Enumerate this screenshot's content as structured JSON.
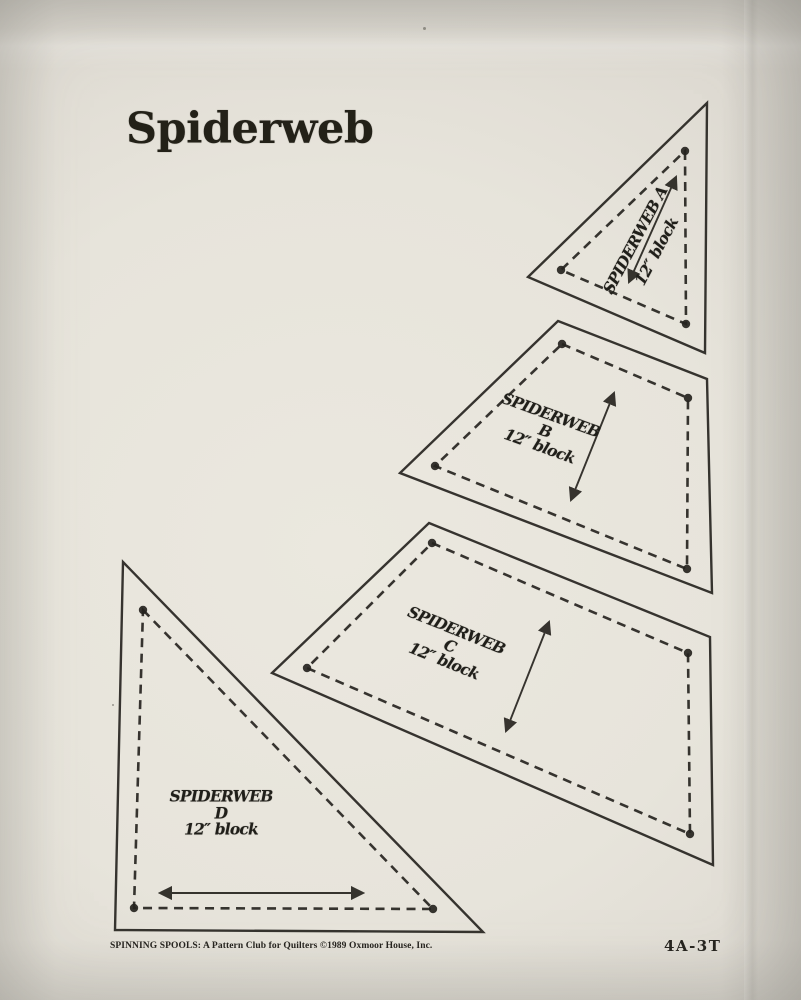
{
  "title": "Spiderweb",
  "pieces": {
    "a": {
      "lines": [
        "SPIDERWEB  A",
        "12″ block"
      ]
    },
    "b": {
      "lines": [
        "SPIDERWEB",
        "B",
        "12″ block"
      ]
    },
    "c": {
      "lines": [
        "SPIDERWEB",
        "C",
        "12″ block"
      ]
    },
    "d": {
      "lines": [
        "SPIDERWEB",
        "D",
        "12″ block"
      ]
    }
  },
  "footer": {
    "credit": "SPINNING SPOOLS: A Pattern Club for Quilters ©1989 Oxmoor House, Inc.",
    "code": "4A-3T"
  },
  "colors": {
    "ink": "#26241f",
    "paper": "#e8e5dc",
    "backdrop": "#d2cfc7"
  }
}
